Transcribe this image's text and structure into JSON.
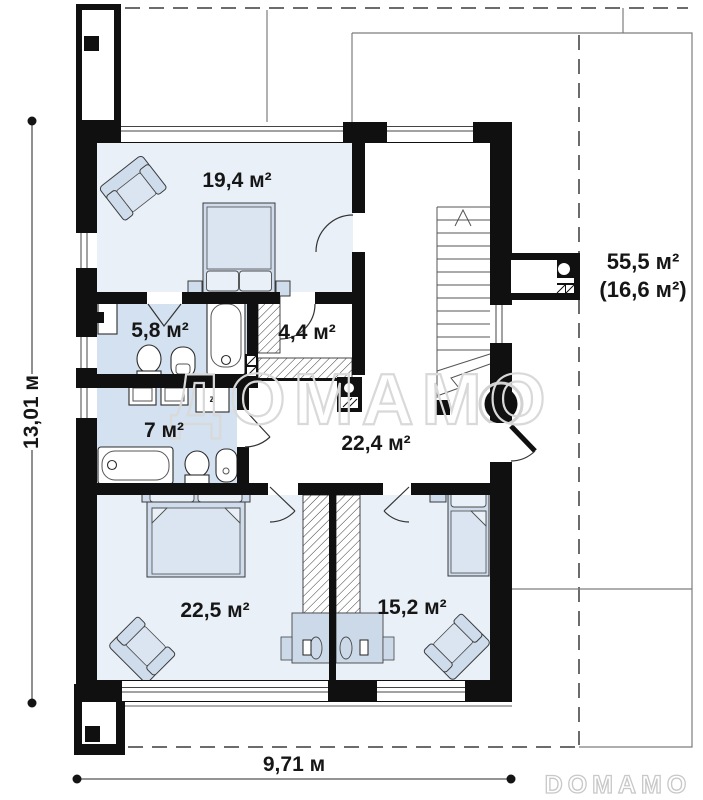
{
  "plan": {
    "watermark_text": "ДОМАМО",
    "brand_logo_text": "DOMAMO",
    "rooms": [
      {
        "id": "bedroom-top",
        "area_label": "19,4 м²"
      },
      {
        "id": "bathroom-small",
        "area_label": "5,8 м²"
      },
      {
        "id": "wardrobe",
        "area_label": "4,4 м²"
      },
      {
        "id": "bathroom-main",
        "area_label": "7 м²"
      },
      {
        "id": "hallway",
        "area_label": "22,4 м²"
      },
      {
        "id": "bedroom-left",
        "area_label": "22,5 м²"
      },
      {
        "id": "bedroom-right",
        "area_label": "15,2 м²"
      }
    ],
    "attic": {
      "total_label": "55,5 м²",
      "usable_label": "(16,6 м²)"
    },
    "dimensions": {
      "height_label": "13,01 м",
      "width_label": "9,71 м"
    },
    "appliance_labels": {
      "washer": "z"
    },
    "colors": {
      "wall": "#101010",
      "bedroom_floor": "#e9f0f8",
      "bathroom_floor": "#d4e1f0",
      "furniture": "#cfdcec",
      "watermark": "#d9d9d9"
    }
  }
}
